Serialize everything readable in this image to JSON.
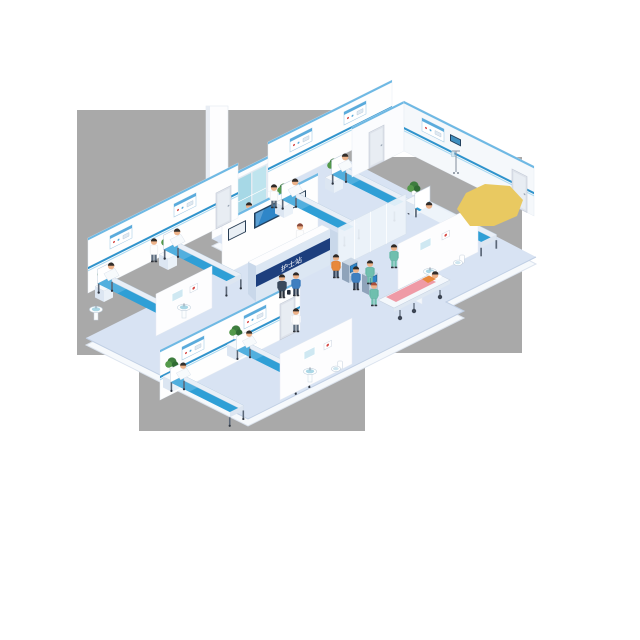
{
  "scene": {
    "title": "Isometric hospital ward floor illustration",
    "canvas": {
      "width": 640,
      "height": 640
    },
    "background_color": "#ffffff",
    "backdrop": {
      "color": "#a9a9a9",
      "blocks": [
        {
          "x": 77,
          "y": 110,
          "w": 273,
          "h": 245
        },
        {
          "x": 139,
          "y": 110,
          "w": 226,
          "h": 321
        },
        {
          "x": 350,
          "y": 157,
          "w": 172,
          "h": 196
        }
      ]
    },
    "palette": {
      "floor": "#d8e3f3",
      "floor_edge": "#f6f9fc",
      "wall": "#fefefe",
      "wall_shaded": "#f5f8fb",
      "wall_trim_blue": "#6fb9e4",
      "bed_rail_blue": "#2f93cc",
      "mattress_blue": "#2f9fd6",
      "desk_band_navy": "#1d3f7e",
      "desk_front": "#dce7f3",
      "scrubs_green": "#6fbfae",
      "highlight_yellow": "#e9c961",
      "plant_green": "#3e7d3e",
      "glass_teal": "#a6d8e6",
      "screen_blue": "#2f86c8",
      "skin": "#edb289"
    },
    "reception": {
      "sign_text": "护士站",
      "sign_text_color": "#ffffff",
      "band_color": "#1d3f7e",
      "staff": "nurse at counter"
    },
    "rooms": [
      {
        "name": "top ward",
        "beds": 2,
        "patients": 2,
        "staff": 2,
        "plants": 2
      },
      {
        "name": "right private room",
        "beds": 1,
        "patients": 1,
        "staff": 1,
        "plants": 1,
        "equipment": [
          "iv-stand",
          "overhead-monitor"
        ]
      },
      {
        "name": "left ward",
        "beds": 2,
        "patients": 2,
        "staff": 1,
        "plants": 2
      },
      {
        "name": "bottom ward",
        "beds": 2,
        "patients": 2,
        "staff": 1,
        "plants": 2
      },
      {
        "name": "corridor",
        "features": [
          "reception-desk",
          "display-wall",
          "self-service-kiosks",
          "glass-entry-door",
          "stretcher"
        ]
      },
      {
        "name": "bathroom-right",
        "fixtures": [
          "sink",
          "toilet",
          "mirror",
          "poster"
        ]
      },
      {
        "name": "bathroom-bottom",
        "fixtures": [
          "sink",
          "toilet",
          "mirror"
        ]
      },
      {
        "name": "bathroom-left",
        "fixtures": [
          "sink",
          "mirror"
        ]
      }
    ],
    "counts": {
      "beds": 7,
      "stretchers": 1,
      "kiosks": 2,
      "display_screens": 3,
      "plants": 7,
      "sinks": 4,
      "toilets": 2,
      "people_total": 22
    }
  }
}
